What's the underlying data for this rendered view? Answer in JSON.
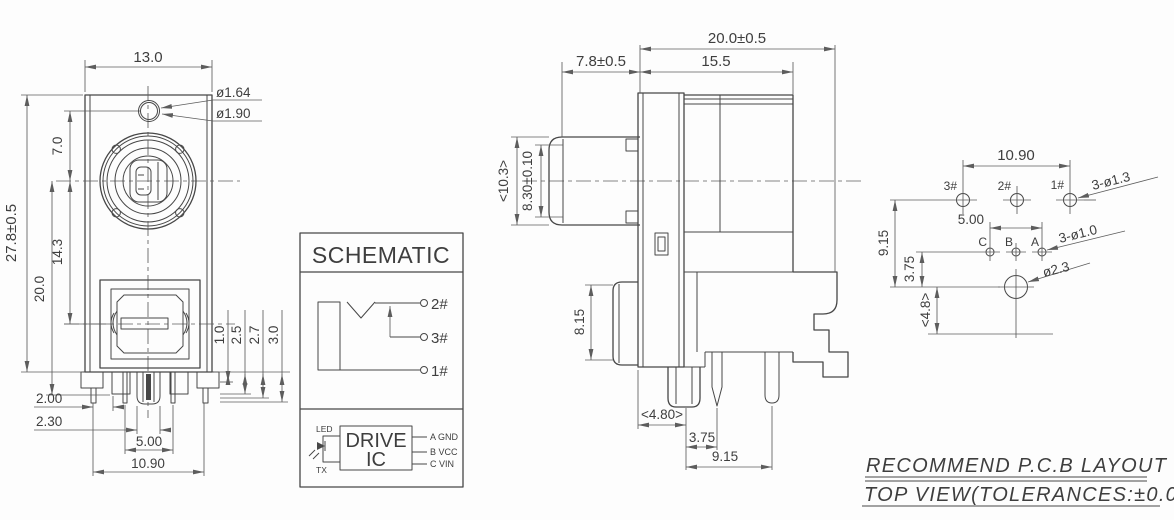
{
  "front_view": {
    "dim_width": "13.0",
    "dim_hole_inner": "ø1.64",
    "dim_hole_outer": "ø1.90",
    "dim_height": "27.8±0.5",
    "dim_jack_to_pins": "20.0",
    "dim_jack_to_usb": "14.3",
    "dim_hole_to_jack": "7.0",
    "dim_pin_a": "1.0",
    "dim_pin_b": "2.5",
    "dim_pin_c": "2.7",
    "dim_pin_d": "3.0",
    "dim_pin_left": "2.00",
    "dim_post_width": "2.30",
    "dim_pin_pitch": "5.00",
    "dim_pin_span": "10.90"
  },
  "schematic": {
    "title": "SCHEMATIC",
    "terminal_2": "2#",
    "terminal_3": "3#",
    "terminal_1": "1#",
    "led": "LED",
    "tx": "TX",
    "ic_line1": "DRIVE",
    "ic_line2": "IC",
    "pin_a": "A GND",
    "pin_b": "B VCC",
    "pin_c": "C VIN"
  },
  "side_view": {
    "dim_total_depth": "20.0±0.5",
    "dim_front_depth": "7.8±0.5",
    "dim_body_depth": "15.5",
    "dim_bezel": "<10.3>",
    "dim_opening": "8.30±0.10",
    "dim_usb_height": "8.15",
    "dim_pin_ref": "<4.80>",
    "dim_pin_gap": "3.75",
    "dim_pin_span": "9.15"
  },
  "pcb_layout": {
    "dim_row1_span": "10.90",
    "label_row1_holes": "3-ø1.3",
    "dim_row2_span": "5.00",
    "label_row2_holes": "3-ø1.0",
    "label_center_hole": "ø2.3",
    "dim_rows_gap": "9.15",
    "dim_row2_gap": "3.75",
    "dim_edge_gap": "<4.8>",
    "hole_3": "3#",
    "hole_2": "2#",
    "hole_1": "1#",
    "pad_c": "C",
    "pad_b": "B",
    "pad_a": "A"
  },
  "notes": {
    "line1": "RECOMMEND P.C.B LAYOUT",
    "line2": "TOP VIEW(TOLERANCES:±0.05)"
  }
}
